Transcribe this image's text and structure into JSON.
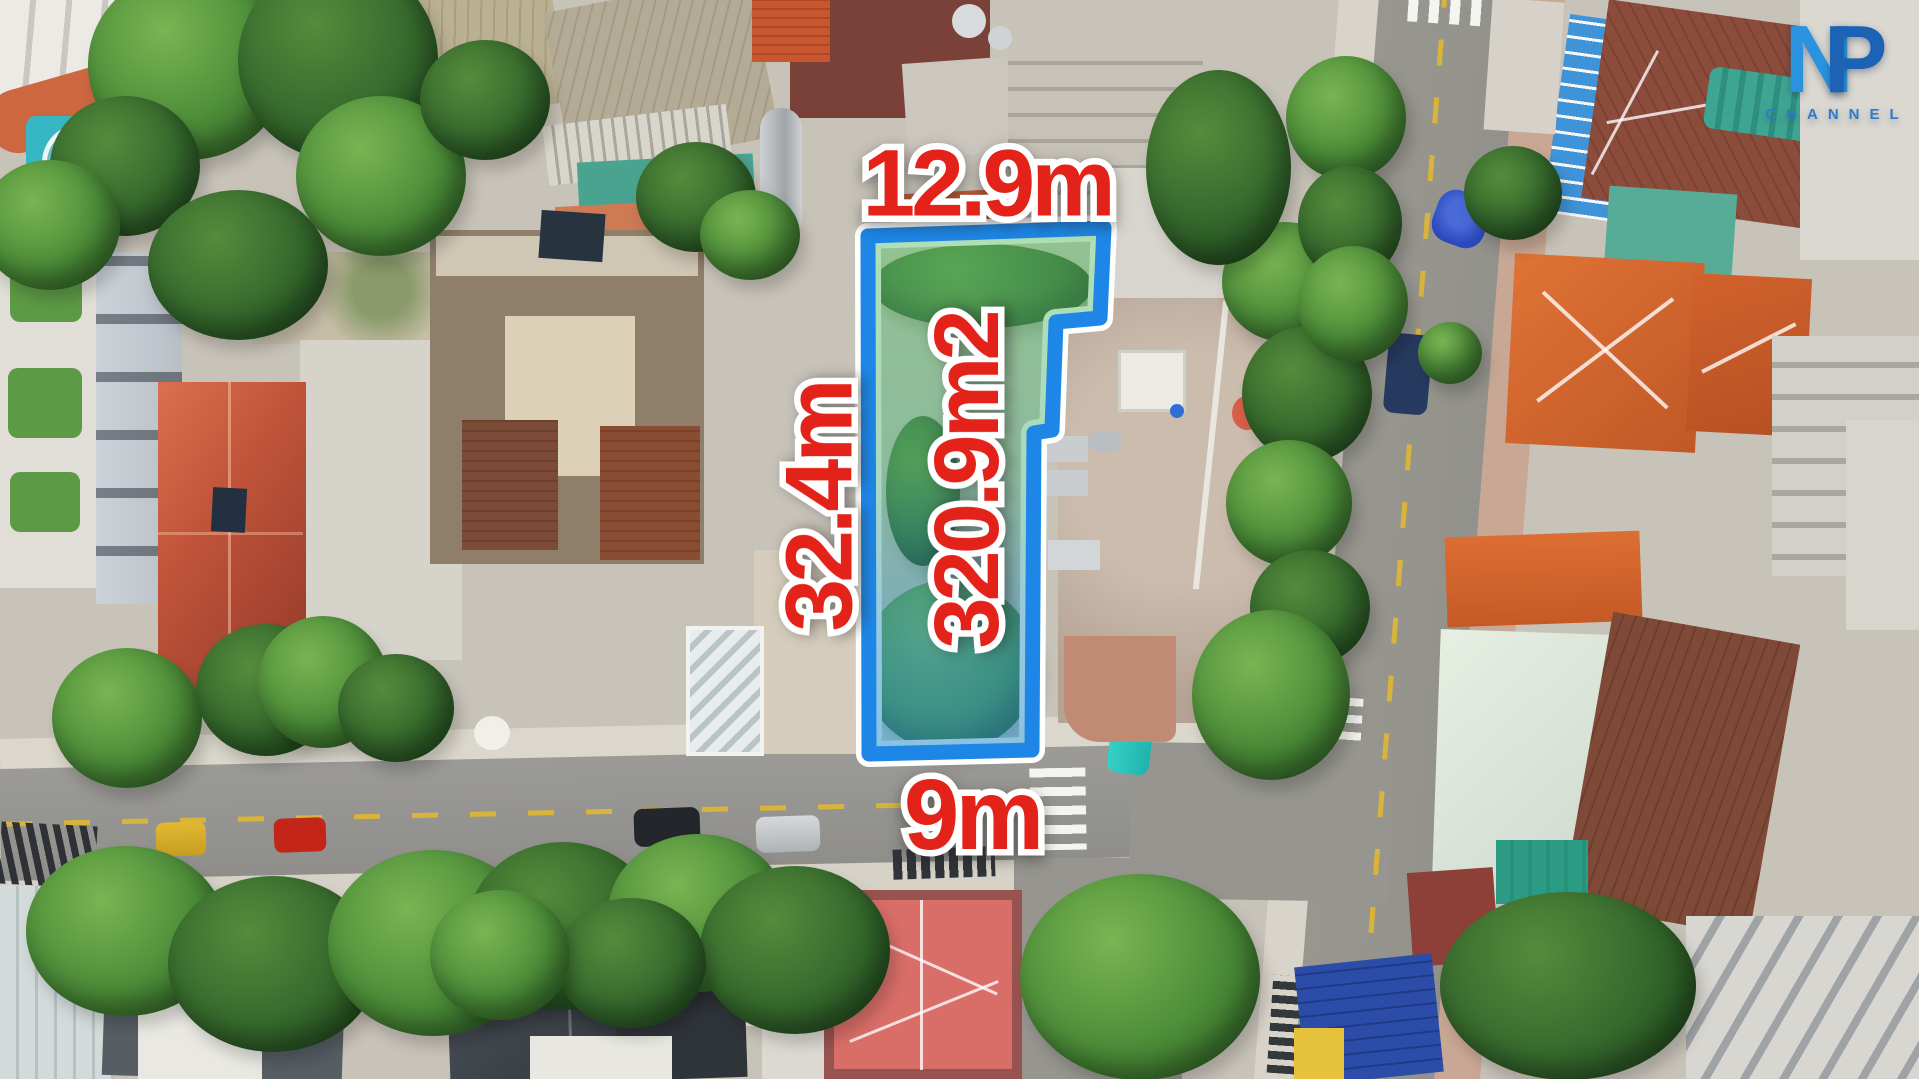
{
  "scene": {
    "labels": {
      "frontage": "12.9m",
      "depth": "32.4m",
      "area": "320.9m2",
      "road_width": "9m"
    },
    "label_style": {
      "text_color": "#e3231a",
      "outline_color": "#ffffff"
    },
    "plot": {
      "border_color": "#1d86e6",
      "outline_color": "#ffffff"
    },
    "watermark": {
      "letter_n": "N",
      "letter_p": "P",
      "subtitle": "CHANNEL",
      "n_color": "#2a93e0",
      "p_color": "#1d63b5",
      "subtitle_color": "#2e7cc8"
    }
  }
}
